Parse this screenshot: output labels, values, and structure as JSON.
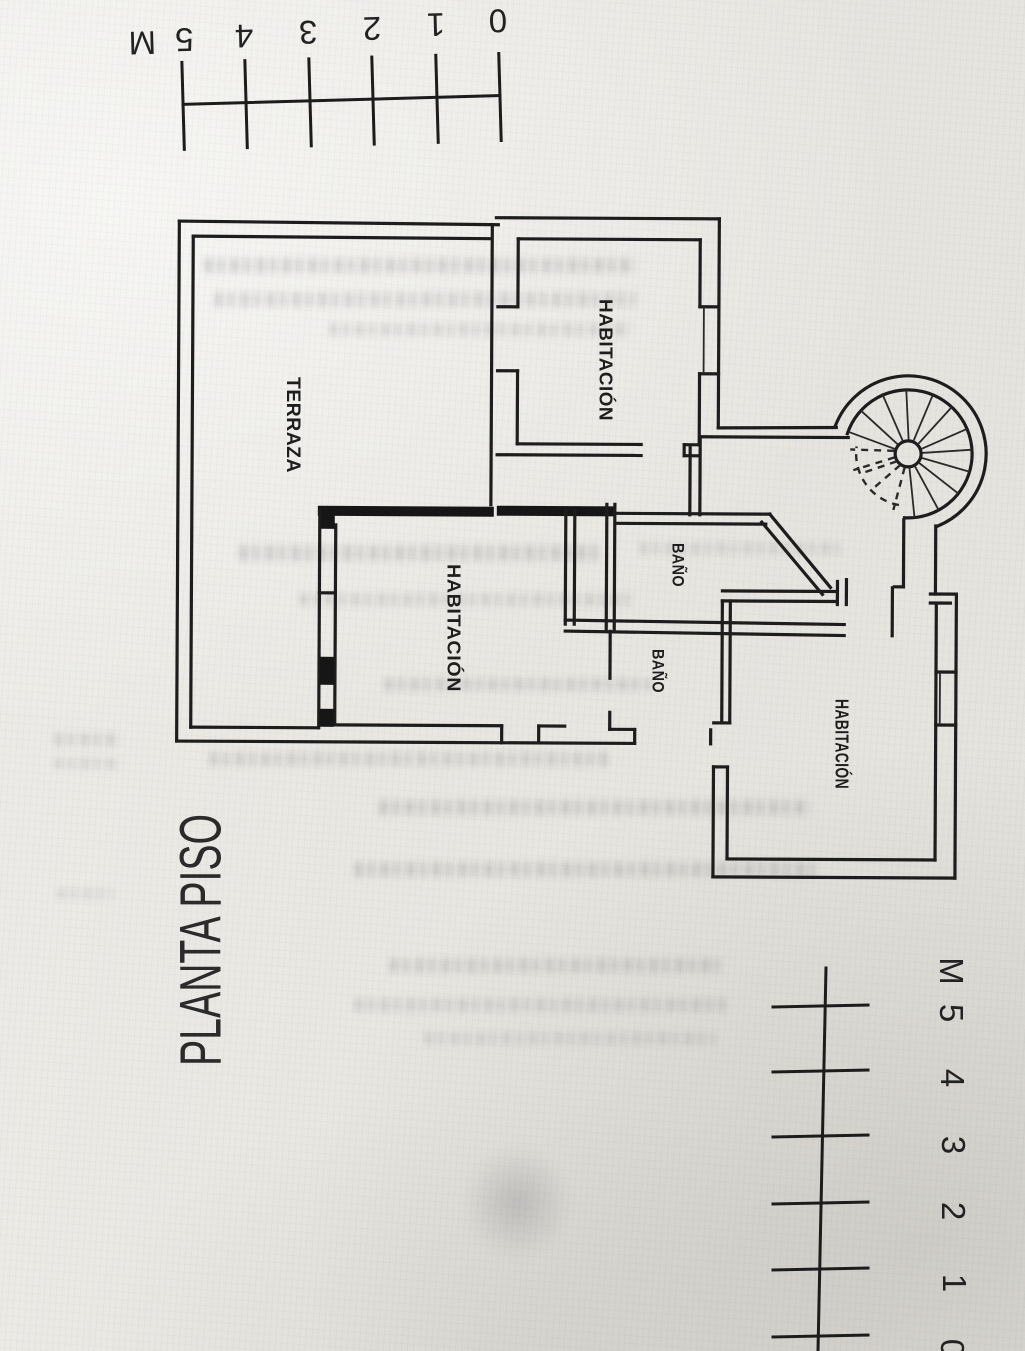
{
  "colors": {
    "ink": "#1d1d1d",
    "paper": "#e9e7e2"
  },
  "title": {
    "text": "PLANTA PISO"
  },
  "rooms": {
    "terraza": {
      "label": "TERRAZA"
    },
    "habitacion_top": {
      "label": "HABITACIÓN"
    },
    "habitacion_middle": {
      "label": "HABITACIÓN"
    },
    "habitacion_bottom": {
      "label": "HABITACIÓN"
    },
    "bano_upper": {
      "label": "BAÑO"
    },
    "bano_lower": {
      "label": "BAÑO"
    }
  },
  "scale_bars": {
    "top": {
      "labels": [
        "0",
        "1",
        "2",
        "3",
        "4",
        "5"
      ],
      "unit": "M"
    },
    "bottom": {
      "labels": [
        "0",
        "1",
        "2",
        "3",
        "4",
        "5"
      ],
      "unit": "M"
    }
  }
}
